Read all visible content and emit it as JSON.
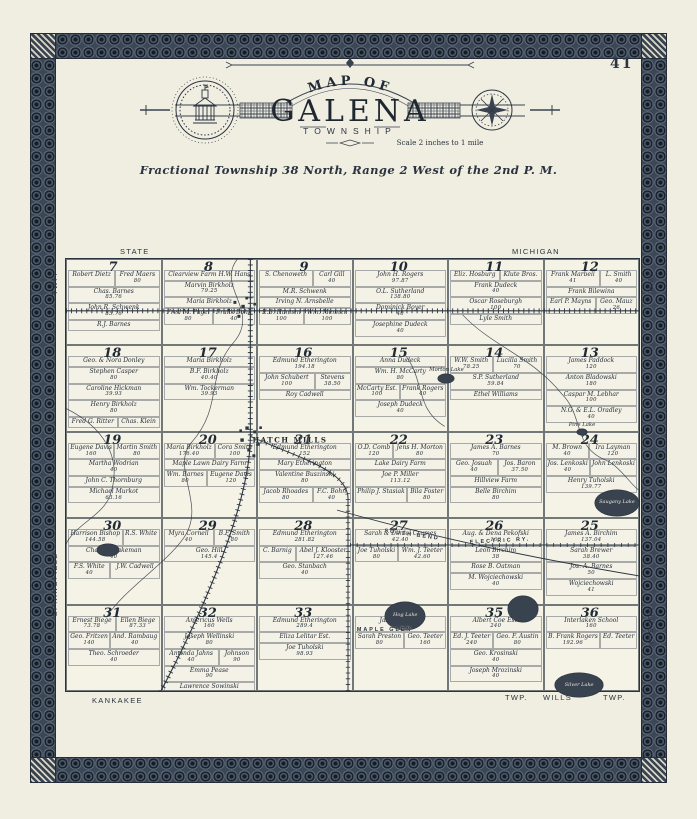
{
  "page": {
    "number": "41"
  },
  "header": {
    "map_of": "MAP OF",
    "title": "GALENA",
    "township": "TOWNSHIP",
    "scale": "Scale 2 inches to 1 mile",
    "legal": "Fractional Township 38 North, Range 2 West of the 2nd P. M."
  },
  "edges": {
    "state": "STATE",
    "michigan": "MICHIGAN",
    "twp_left": "TWP.",
    "springfield": "SPRINGFIELD",
    "twp_right": "TWP.",
    "hudson": "HUDSON",
    "kankakee": "KANKAKEE",
    "twp_b1": "TWP.",
    "wills": "WILLS",
    "twp_b2": "TWP."
  },
  "map": {
    "sections": [
      {
        "number": 7,
        "parcels": [
          {
            "n": "Robert Dietz"
          },
          {
            "n": "Fred Maers",
            "a": "80"
          },
          {
            "n": "Chas. Barnes",
            "a": "85.76"
          },
          {
            "n": "John R. Schwenk",
            "a": "85.76"
          },
          {
            "n": "R.J. Barnes"
          }
        ]
      },
      {
        "number": 8,
        "parcels": [
          {
            "n": "Clearview Farm H.W. Hans"
          },
          {
            "n": "Marvin Birkholz",
            "a": "79.25"
          },
          {
            "n": "Maria Birkholz"
          },
          {
            "n": "Fred M. Pagel",
            "a": "80"
          },
          {
            "n": "Frank Bohn",
            "a": "40"
          }
        ]
      },
      {
        "number": 9,
        "parcels": [
          {
            "n": "S. Chenoweth"
          },
          {
            "n": "Carl Gill",
            "a": "40"
          },
          {
            "n": "M.R. Schwenk"
          },
          {
            "n": "Irving N. Arnsbelle"
          },
          {
            "n": "E.B. Hannen",
            "a": "100"
          },
          {
            "n": "Wm. Mennen",
            "a": "100"
          }
        ]
      },
      {
        "number": 10,
        "parcels": [
          {
            "n": "John H. Rogers",
            "a": "97.87"
          },
          {
            "n": "O.L. Sutherland",
            "a": "138.80"
          },
          {
            "n": "Dominick Boyer",
            "a": "40"
          },
          {
            "n": "Josephine Dudeck",
            "a": "40"
          }
        ]
      },
      {
        "number": 11,
        "parcels": [
          {
            "n": "Eliz. Hosburg"
          },
          {
            "n": "Klute Bros."
          },
          {
            "n": "Frank Dudeck",
            "a": "40"
          },
          {
            "n": "Oscar Roseburgh",
            "a": "100"
          },
          {
            "n": "Lyle Smith"
          }
        ]
      },
      {
        "number": 12,
        "parcels": [
          {
            "n": "Frank Marbell",
            "a": "41"
          },
          {
            "n": "L. Smith",
            "a": "40"
          },
          {
            "n": "Frank Bilewina"
          },
          {
            "n": "Earl P. Mayns"
          },
          {
            "n": "Geo. Mauz",
            "a": "26"
          }
        ]
      },
      {
        "number": 18,
        "parcels": [
          {
            "n": "Geo. & Nora Donley"
          },
          {
            "n": "Stephen Casper",
            "a": "80"
          },
          {
            "n": "Caroline Hickman",
            "a": "39.93"
          },
          {
            "n": "Henry Birkholz",
            "a": "80"
          },
          {
            "n": "Fred G. Ritter"
          },
          {
            "n": "Chas. Klein"
          }
        ]
      },
      {
        "number": 17,
        "parcels": [
          {
            "n": "Maria Birkholz"
          },
          {
            "n": "B.F. Birkholz",
            "a": "40.40"
          },
          {
            "n": "Wm. Tockerman",
            "a": "39.93"
          }
        ]
      },
      {
        "number": 16,
        "parcels": [
          {
            "n": "Edmund Etherington",
            "a": "194.18"
          },
          {
            "n": "John Schubert",
            "a": "100"
          },
          {
            "n": "Stevens",
            "a": "38.50"
          },
          {
            "n": "Roy Cadwell"
          }
        ]
      },
      {
        "number": 15,
        "parcels": [
          {
            "n": "Anna Dudeck"
          },
          {
            "n": "Wm. H. McCarty",
            "a": "80"
          },
          {
            "n": "McCarty Est.",
            "a": "100"
          },
          {
            "n": "Frank Rogers",
            "a": "40"
          },
          {
            "n": "Joseph Dudeck",
            "a": "40"
          }
        ]
      },
      {
        "number": 14,
        "parcels": [
          {
            "n": "W.W. Smith",
            "a": "78.25"
          },
          {
            "n": "Lucilla Smith",
            "a": "70"
          },
          {
            "n": "S.P. Sutherland",
            "a": "59.84"
          },
          {
            "n": "Ethel Williams"
          }
        ]
      },
      {
        "number": 13,
        "parcels": [
          {
            "n": "James Paddock",
            "a": "120"
          },
          {
            "n": "Anton Bladowski",
            "a": "180"
          },
          {
            "n": "Caspar M. Lebhar",
            "a": "100"
          },
          {
            "n": "N.G. & E.L. Oradley",
            "a": "40"
          }
        ]
      },
      {
        "number": 19,
        "parcels": [
          {
            "n": "Eugene Davis",
            "a": "160"
          },
          {
            "n": "Martin Smith",
            "a": "80"
          },
          {
            "n": "Martha Wodrian",
            "a": "40"
          },
          {
            "n": "John C. Thornburg"
          },
          {
            "n": "Michael Murkot",
            "a": "63.16"
          }
        ]
      },
      {
        "number": 20,
        "parcels": [
          {
            "n": "Maria Birkholz",
            "a": "176.40"
          },
          {
            "n": "Cora Smith",
            "a": "100"
          },
          {
            "n": "Maple Lawn Dairy Farm"
          },
          {
            "n": "Wm. Barnes",
            "a": "80"
          },
          {
            "n": "Eugene Davis",
            "a": "120"
          }
        ]
      },
      {
        "number": 21,
        "parcels": [
          {
            "n": "Edmund Etherington",
            "a": "152"
          },
          {
            "n": "Mary Etherington"
          },
          {
            "n": "Valentine Buszinski",
            "a": "80"
          },
          {
            "n": "Jacob Rhoades",
            "a": "80"
          },
          {
            "n": "F.C. Bohn",
            "a": "40"
          }
        ]
      },
      {
        "number": 22,
        "parcels": [
          {
            "n": "O.D. Comb",
            "a": "120"
          },
          {
            "n": "Jens H. Morton",
            "a": "80"
          },
          {
            "n": "Lake Dairy Farm"
          },
          {
            "n": "Joe P. Miller",
            "a": "113.12"
          },
          {
            "n": "Philip J. Stasiak"
          },
          {
            "n": "Bila Foster",
            "a": "80"
          }
        ]
      },
      {
        "number": 23,
        "parcels": [
          {
            "n": "James A. Barnes",
            "a": "70"
          },
          {
            "n": "Geo. Josuah",
            "a": "40"
          },
          {
            "n": "Jos. Baron",
            "a": "37.50"
          },
          {
            "n": "Hillview Farm"
          },
          {
            "n": "Belle Birchim",
            "a": "80"
          }
        ]
      },
      {
        "number": 24,
        "parcels": [
          {
            "n": "M. Brown",
            "a": "40"
          },
          {
            "n": "Ira Layman",
            "a": "120"
          },
          {
            "n": "Jos. Lenkoski",
            "a": "40"
          },
          {
            "n": "John Lenkoski"
          },
          {
            "n": "Henry Tuholski",
            "a": "139.77"
          }
        ]
      },
      {
        "number": 30,
        "parcels": [
          {
            "n": "Harrison Bishop",
            "a": "144.58"
          },
          {
            "n": "R.S. White"
          },
          {
            "n": "Chas. B. Bakeman",
            "a": "40"
          },
          {
            "n": "F.S. White",
            "a": "40"
          },
          {
            "n": "J.W. Cadwell"
          }
        ]
      },
      {
        "number": 29,
        "parcels": [
          {
            "n": "Myra Cornell",
            "a": "40"
          },
          {
            "n": "B.F. Smith",
            "a": "80"
          },
          {
            "n": "Geo. Hill",
            "a": "145.4"
          }
        ]
      },
      {
        "number": 28,
        "parcels": [
          {
            "n": "Edmund Etherington",
            "a": "281.82"
          },
          {
            "n": "C. Barnig"
          },
          {
            "n": "Abel J. Klooster",
            "a": "127.46"
          },
          {
            "n": "Geo. Stanbach",
            "a": "40"
          }
        ]
      },
      {
        "number": 27,
        "parcels": [
          {
            "n": "Sarah & Daniel Crumes",
            "a": "42.40"
          },
          {
            "n": "Joe Tuholski",
            "a": "80"
          },
          {
            "n": "Wm. J. Teeter",
            "a": "42.60"
          }
        ]
      },
      {
        "number": 26,
        "parcels": [
          {
            "n": "Aug. & Dena Pekofski",
            "a": "160"
          },
          {
            "n": "Leon Birchim",
            "a": "38"
          },
          {
            "n": "Rose B. Oatman"
          },
          {
            "n": "M. Wojciechowski",
            "a": "40"
          }
        ]
      },
      {
        "number": 25,
        "parcels": [
          {
            "n": "James A. Birchim",
            "a": "137.04"
          },
          {
            "n": "Sarah Brewer",
            "a": "38.40"
          },
          {
            "n": "Jos. A. Barnes",
            "a": "50"
          },
          {
            "n": "Wojciechowski",
            "a": "41"
          }
        ]
      },
      {
        "number": 31,
        "parcels": [
          {
            "n": "Ernest Biege",
            "a": "73.78"
          },
          {
            "n": "Ellen Biege",
            "a": "87.33"
          },
          {
            "n": "Geo. Fritzen",
            "a": "140"
          },
          {
            "n": "And. Rambaug",
            "a": "40"
          },
          {
            "n": "Theo. Schroeder",
            "a": "40"
          }
        ]
      },
      {
        "number": 32,
        "parcels": [
          {
            "n": "Americus Wells",
            "a": "160"
          },
          {
            "n": "Joseph Wellinski",
            "a": "80"
          },
          {
            "n": "Amanda Jahns",
            "a": "40"
          },
          {
            "n": "Johnson",
            "a": "90"
          },
          {
            "n": "Emma Pease",
            "a": "90"
          },
          {
            "n": "Lawrence Sowinski",
            "a": "40"
          },
          {
            "n": "Frank Bednarek",
            "a": "40"
          }
        ]
      },
      {
        "number": 33,
        "parcels": [
          {
            "n": "Edmund Etherington",
            "a": "289.4"
          },
          {
            "n": "Eliza Lelitar Est."
          },
          {
            "n": "Joe Tuholski",
            "a": "98.93"
          }
        ]
      },
      {
        "number": 34,
        "parcels": [
          {
            "n": "Jas. E. Bowell",
            "a": "340"
          },
          {
            "n": "Sarah Preston",
            "a": "80"
          },
          {
            "n": "Geo. Teeter",
            "a": "160"
          }
        ]
      },
      {
        "number": 35,
        "parcels": [
          {
            "n": "Albert Coe Est.",
            "a": "240"
          },
          {
            "n": "Ed. J. Teeter",
            "a": "240"
          },
          {
            "n": "Geo. F. Austin",
            "a": "80"
          },
          {
            "n": "Geo. Krosinski",
            "a": "40"
          },
          {
            "n": "Joseph Mrozinski",
            "a": "40"
          }
        ]
      },
      {
        "number": 36,
        "parcels": [
          {
            "n": "Interlaken School",
            "a": "160"
          },
          {
            "n": "B. Frank Rogers",
            "a": "192.96"
          },
          {
            "n": "Ed. Teeter"
          }
        ]
      }
    ],
    "lakes": [
      {
        "name": "Morton Lake",
        "x": 65.0,
        "y": 26.6,
        "w": 2.8,
        "h": 2.1,
        "labelmode": "above"
      },
      {
        "name": "Pine Lake",
        "x": 89.2,
        "y": 39.4,
        "w": 1.7,
        "h": 1.4,
        "labelmode": "above"
      },
      {
        "name": "Saugany Lake",
        "x": 92.3,
        "y": 53.5,
        "w": 7.7,
        "h": 6.0,
        "labelmode": "in"
      },
      {
        "name": "Hog Lake",
        "x": 55.7,
        "y": 79.3,
        "w": 7.0,
        "h": 6.5,
        "labelmode": "in"
      },
      {
        "name": "pond",
        "x": 5.4,
        "y": 65.9,
        "w": 3.8,
        "h": 2.8,
        "labelmode": "none"
      },
      {
        "name": "pond",
        "x": 77.2,
        "y": 78.1,
        "w": 5.2,
        "h": 6.0,
        "labelmode": "none"
      },
      {
        "name": "Silver Lake",
        "x": 85.4,
        "y": 95.9,
        "w": 8.3,
        "h": 5.5,
        "labelmode": "in"
      }
    ],
    "places": [
      {
        "name": "HATCH MILLS",
        "x": 39.1,
        "y": 41.9,
        "cls": "",
        "rot": 0
      },
      {
        "name": "MAPLE GLEN",
        "x": 55.6,
        "y": 85.9,
        "cls": "road",
        "rot": 0
      },
      {
        "name": "SOUTH BEND",
        "x": 60.3,
        "y": 63.8,
        "cls": "road",
        "rot": 8
      },
      {
        "name": "ELECTRIC RY.",
        "x": 75.7,
        "y": 65.2,
        "cls": "road",
        "rot": -3
      }
    ]
  }
}
